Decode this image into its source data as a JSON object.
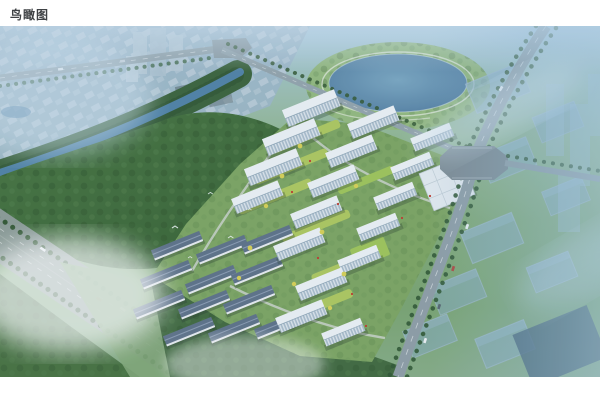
{
  "page": {
    "title": "鸟瞰图"
  },
  "image": {
    "type": "architectural-aerial-rendering",
    "subject": "residential development bird's-eye view with lake, forest park, highway and planned context buildings",
    "colors": {
      "sky_haze": "#a9c9de",
      "forest_green": "#3f6a3b",
      "parkland_green": "#8fb578",
      "lake_blue": "#5d88a8",
      "road_gray": "#8e9da4",
      "tower_white": "#edf2f5",
      "facade_glass": "#a9bcca",
      "townhouse_roof": "#5d7086",
      "courtyard_green": "#aec75c",
      "accent_yellow": "#d8d052",
      "accent_red": "#c0392b",
      "ghost_building_blue": "#86a9c4"
    }
  }
}
